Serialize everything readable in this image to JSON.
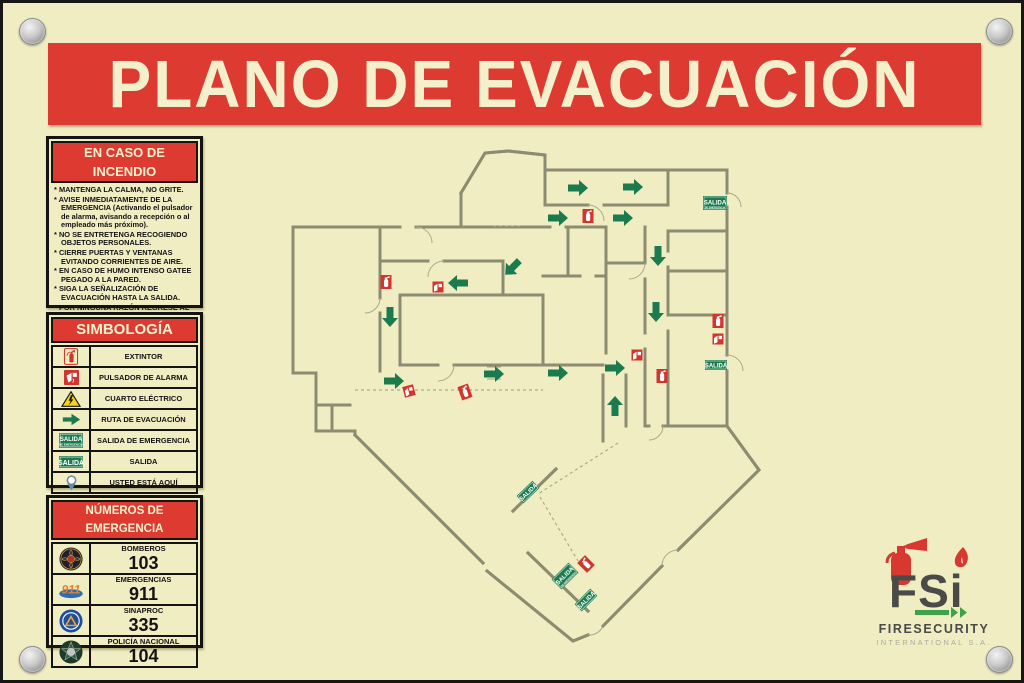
{
  "title": "PLANO DE EVACUACIÓN",
  "colors": {
    "plate": "#F0EDC3",
    "red": "#DD3A31",
    "green": "#1B7B4F",
    "wall": "#8C8C70",
    "cream_text": "#F4F0CB"
  },
  "fire_instructions": {
    "header": "EN CASO DE INCENDIO",
    "items": [
      "MANTENGA LA CALMA, NO GRITE.",
      "AVISE INMEDIATAMENTE DE LA EMERGENCIA (Activando el pulsador de alarma, avisando a recepción o al empleado más próximo).",
      "NO SE ENTRETENGA RECOGIENDO OBJETOS PERSONALES.",
      "CIERRE PUERTAS Y VENTANAS EVITANDO CORRIENTES DE AIRE.",
      "EN CASO DE HUMO INTENSO GATEE PEGADO A LA PARED.",
      "SIGA LA SEÑALIZACIÓN DE EVACUACIÓN HASTA LA SALIDA.",
      "POR NINGUNA RAZÓN REGRESE AL INTERIOR.",
      "NO USAR EL ASCENSOR EN CASO DE EMERGENCIA."
    ]
  },
  "legend": {
    "header": "SIMBOLOGÍA",
    "sign_top": "SALIDA",
    "sign_sub": "DE EMERGENCIA",
    "rows": [
      {
        "icon": "extinguisher-icon",
        "label": "EXTINTOR"
      },
      {
        "icon": "alarm-button-icon",
        "label": "PULSADOR DE ALARMA"
      },
      {
        "icon": "electrical-room-icon",
        "label": "CUARTO ELÉCTRICO"
      },
      {
        "icon": "evacuation-route-icon",
        "label": "RUTA DE EVACUACIÓN"
      },
      {
        "icon": "emergency-exit-sign-icon",
        "label": "SALIDA DE EMERGENCIA"
      },
      {
        "icon": "exit-sign-icon",
        "label": "SALIDA"
      },
      {
        "icon": "you-are-here-icon",
        "label": "USTED ESTÁ AQUÍ"
      }
    ]
  },
  "emergency_numbers": {
    "header": "NÚMEROS DE EMERGENCIA",
    "rows": [
      {
        "icon": "firefighters-badge",
        "name": "BOMBEROS",
        "number": "103"
      },
      {
        "icon": "911-badge",
        "name": "EMERGENCIAS",
        "number": "911"
      },
      {
        "icon": "sinaproc-badge",
        "name": "SINAPROC",
        "number": "335"
      },
      {
        "icon": "national-police-badge",
        "name": "POLICÍA NACIONAL",
        "number": "104"
      }
    ]
  },
  "plan": {
    "exit_sign_label": "SALIDA",
    "exit_sign_sub_label": "DE EMERGENCIA",
    "arrows": [
      {
        "x": 289,
        "y": 45,
        "r": 0
      },
      {
        "x": 344,
        "y": 44,
        "r": 0
      },
      {
        "x": 269,
        "y": 75,
        "r": 0
      },
      {
        "x": 334,
        "y": 75,
        "r": 0
      },
      {
        "x": 370,
        "y": 112,
        "r": 90
      },
      {
        "x": 368,
        "y": 168,
        "r": 90
      },
      {
        "x": 225,
        "y": 124,
        "r": 135
      },
      {
        "x": 171,
        "y": 140,
        "r": 180
      },
      {
        "x": 102,
        "y": 173,
        "r": 90
      },
      {
        "x": 105,
        "y": 238,
        "r": 0
      },
      {
        "x": 205,
        "y": 231,
        "r": 0
      },
      {
        "x": 269,
        "y": 230,
        "r": 0
      },
      {
        "x": 326,
        "y": 225,
        "r": 0
      },
      {
        "x": 327,
        "y": 264,
        "r": 270
      }
    ],
    "extinguishers": [
      {
        "x": 300,
        "y": 73,
        "r": 0
      },
      {
        "x": 98,
        "y": 139,
        "r": 0
      },
      {
        "x": 430,
        "y": 178,
        "r": 0
      },
      {
        "x": 374,
        "y": 233,
        "r": 0
      },
      {
        "x": 177,
        "y": 249,
        "r": -20
      },
      {
        "x": 298,
        "y": 421,
        "r": -45
      }
    ],
    "alarms": [
      {
        "x": 150,
        "y": 144,
        "r": 0
      },
      {
        "x": 430,
        "y": 196,
        "r": 0
      },
      {
        "x": 349,
        "y": 212,
        "r": 0
      },
      {
        "x": 121,
        "y": 248,
        "r": -15
      }
    ],
    "exit_signs": [
      {
        "x": 427,
        "y": 60,
        "r": 0,
        "type": "large"
      },
      {
        "x": 428,
        "y": 222,
        "r": 0,
        "type": "small"
      },
      {
        "x": 240,
        "y": 349,
        "r": -44,
        "type": "small"
      },
      {
        "x": 277,
        "y": 433,
        "r": -45,
        "type": "large"
      },
      {
        "x": 298,
        "y": 457,
        "r": -45,
        "type": "small"
      }
    ]
  },
  "logo": {
    "acronym": "FSi",
    "name": "FIRESECURITY",
    "subtitle": "INTERNATIONAL S.A."
  }
}
